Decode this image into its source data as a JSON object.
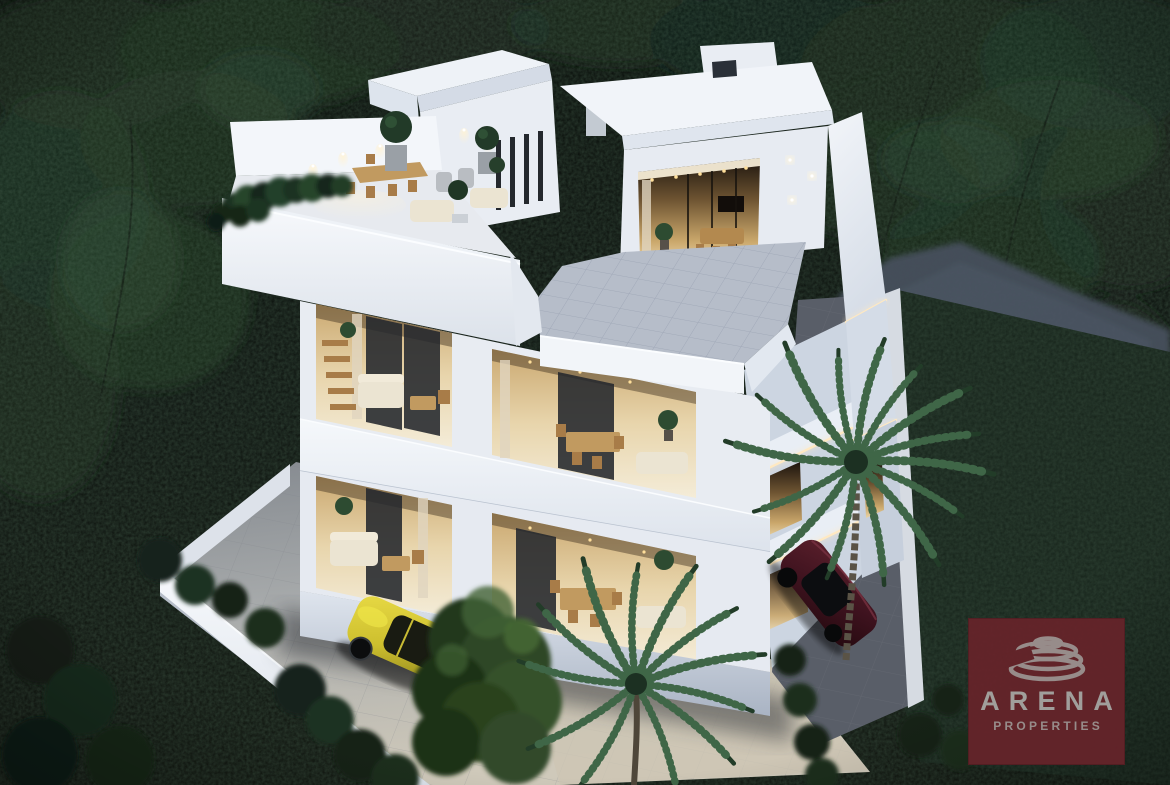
{
  "watermark": {
    "brand": "ARENA",
    "tagline": "PROPERTIES"
  },
  "icons": {
    "logo_mark": "amphitheater-rings-icon"
  },
  "colors": {
    "logo_red": "#66242a",
    "logo_text": "#a9a6a3",
    "building_white": "#edf1f6",
    "building_shadow": "#ccd5e1",
    "interior_warm": "#e8d2a4",
    "forest_dark": "#0c110d",
    "foliage_mid": "#24402b",
    "palm_green": "#3a5c41",
    "deck_tile": "#b6bdc9",
    "driveway_gray": "#a7aaab",
    "yard_beige": "#cdc6b4",
    "path_gray": "#46505c",
    "fence_white": "#d6dbe2",
    "car_yellow": "#d3c636",
    "car_red": "#471824",
    "light_warm": "#ffe9c2"
  }
}
